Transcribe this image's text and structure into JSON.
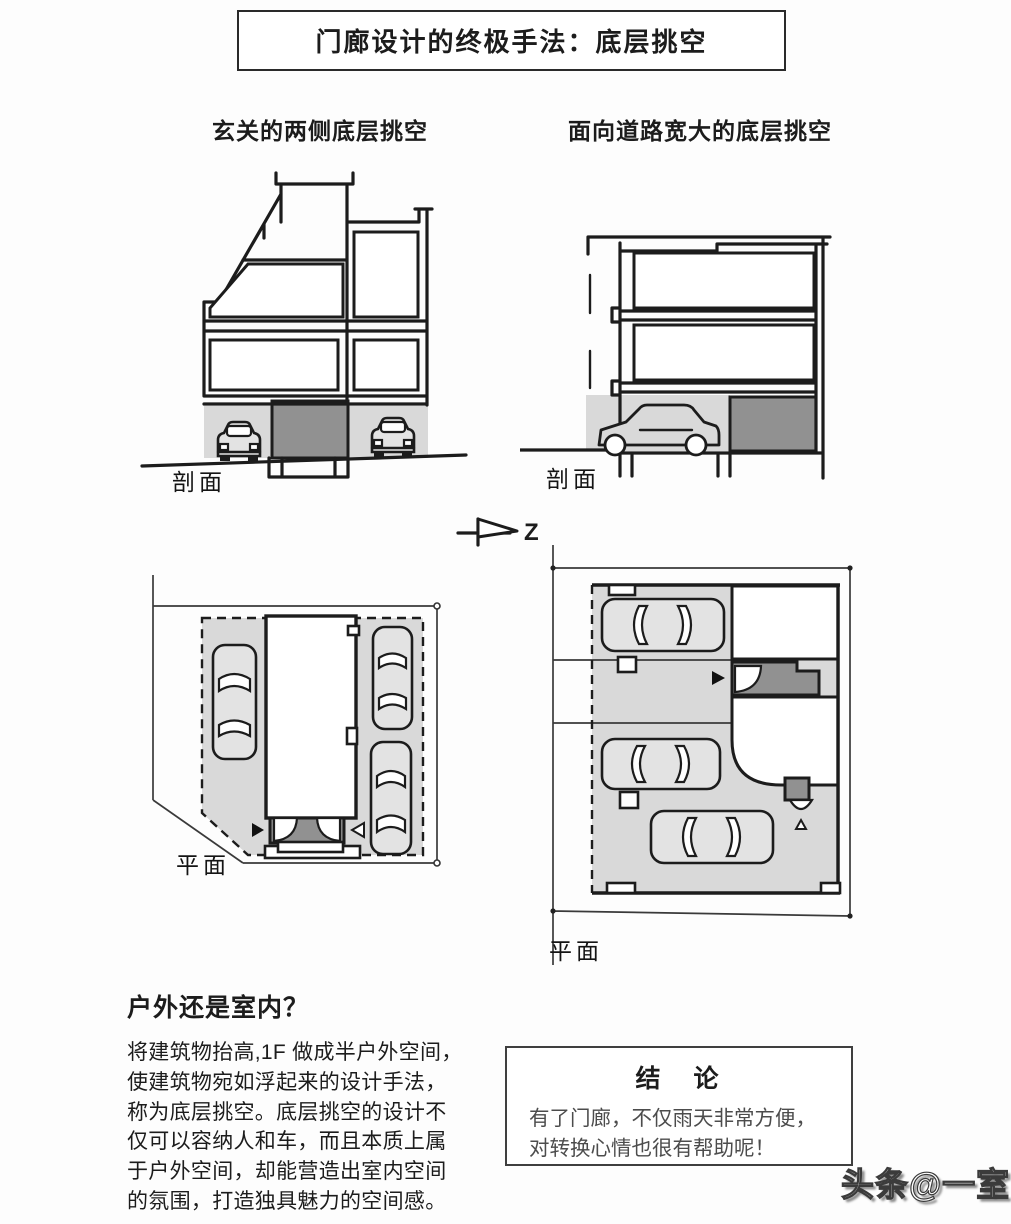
{
  "page": {
    "title": "门廊设计的终极手法：底层挑空",
    "watermark": "头条@一室"
  },
  "columns": {
    "left": {
      "heading": "玄关的两侧底层挑空",
      "section_label": "剖面",
      "plan_label": "平面"
    },
    "right": {
      "heading": "面向道路宽大的底层挑空",
      "section_label": "剖面",
      "plan_label": "平面"
    }
  },
  "compass": {
    "label": "Z"
  },
  "question_section": {
    "heading": "户外还是室内？",
    "lines": [
      "将建筑物抬高,1F 做成半户外空间，",
      "使建筑物宛如浮起来的设计手法，",
      "称为底层挑空。底层挑空的设计不",
      "仅可以容纳人和车，而且本质上属",
      "于户外空间，却能营造出室内空间",
      "的氛围，打造独具魅力的空间感。"
    ]
  },
  "conclusion": {
    "title": "结　论",
    "lines": [
      "有了门廊，不仅雨天非常方便，",
      "对转换心情也很有帮助呢！"
    ]
  },
  "drawing_colors": {
    "light_gray": "#d9d9d9",
    "dark_gray": "#919191",
    "line": "#1c1c1c"
  }
}
